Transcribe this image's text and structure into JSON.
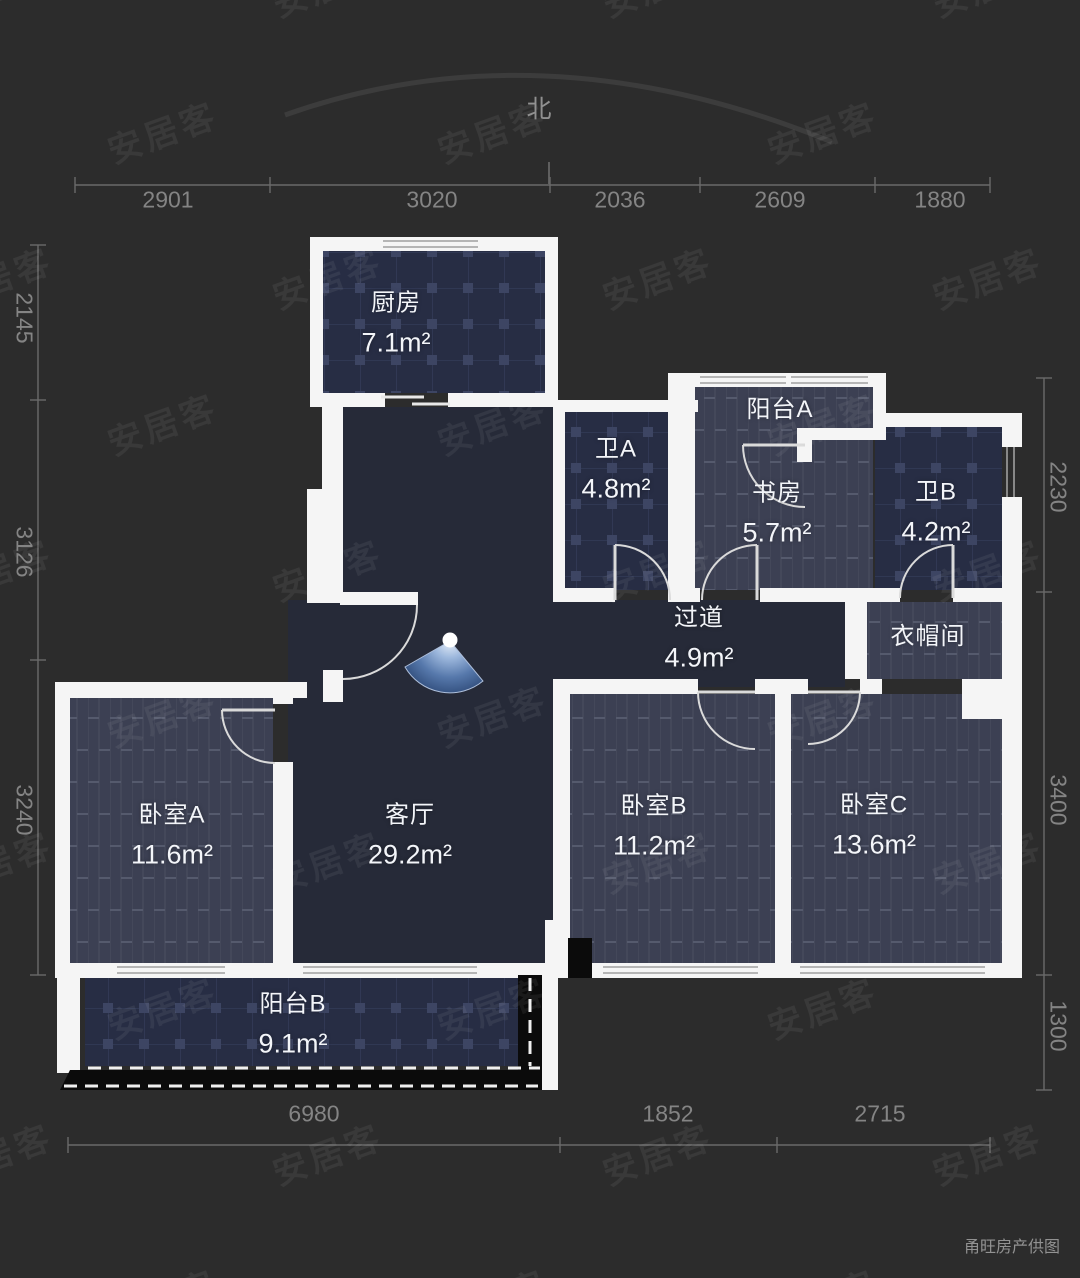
{
  "page": {
    "background": "#2c2c2c",
    "credit": "甬旺房产供图",
    "watermark_text": "安居客"
  },
  "compass": {
    "label": "北"
  },
  "rooms": [
    {
      "id": "kitchen",
      "name": "厨房",
      "area": "7.1m²"
    },
    {
      "id": "bath-a",
      "name": "卫A",
      "area": "4.8m²"
    },
    {
      "id": "balcony-a",
      "name": "阳台A",
      "area": ""
    },
    {
      "id": "study",
      "name": "书房",
      "area": "5.7m²"
    },
    {
      "id": "bath-b",
      "name": "卫B",
      "area": "4.2m²"
    },
    {
      "id": "hallway",
      "name": "过道",
      "area": "4.9m²"
    },
    {
      "id": "closet",
      "name": "衣帽间",
      "area": ""
    },
    {
      "id": "bedroom-a",
      "name": "卧室A",
      "area": "11.6m²"
    },
    {
      "id": "living",
      "name": "客厅",
      "area": "29.2m²"
    },
    {
      "id": "bedroom-b",
      "name": "卧室B",
      "area": "11.2m²"
    },
    {
      "id": "bedroom-c",
      "name": "卧室C",
      "area": "13.6m²"
    },
    {
      "id": "balcony-b",
      "name": "阳台B",
      "area": "9.1m²"
    }
  ],
  "dimensions": {
    "top": [
      "2901",
      "3020",
      "2036",
      "2609",
      "1880"
    ],
    "bottom": [
      "6980",
      "1852",
      "2715"
    ],
    "left": [
      "2145",
      "3126",
      "3240"
    ],
    "right": [
      "2230",
      "3400",
      "1300"
    ]
  },
  "colors": {
    "wall": "#f5f5f5",
    "floor_plain": "#262a38",
    "floor_tile": "#272d44",
    "floor_wood": "#3c4053",
    "dimension_text": "#848484",
    "view_marker_blue": "#2e4a78"
  }
}
